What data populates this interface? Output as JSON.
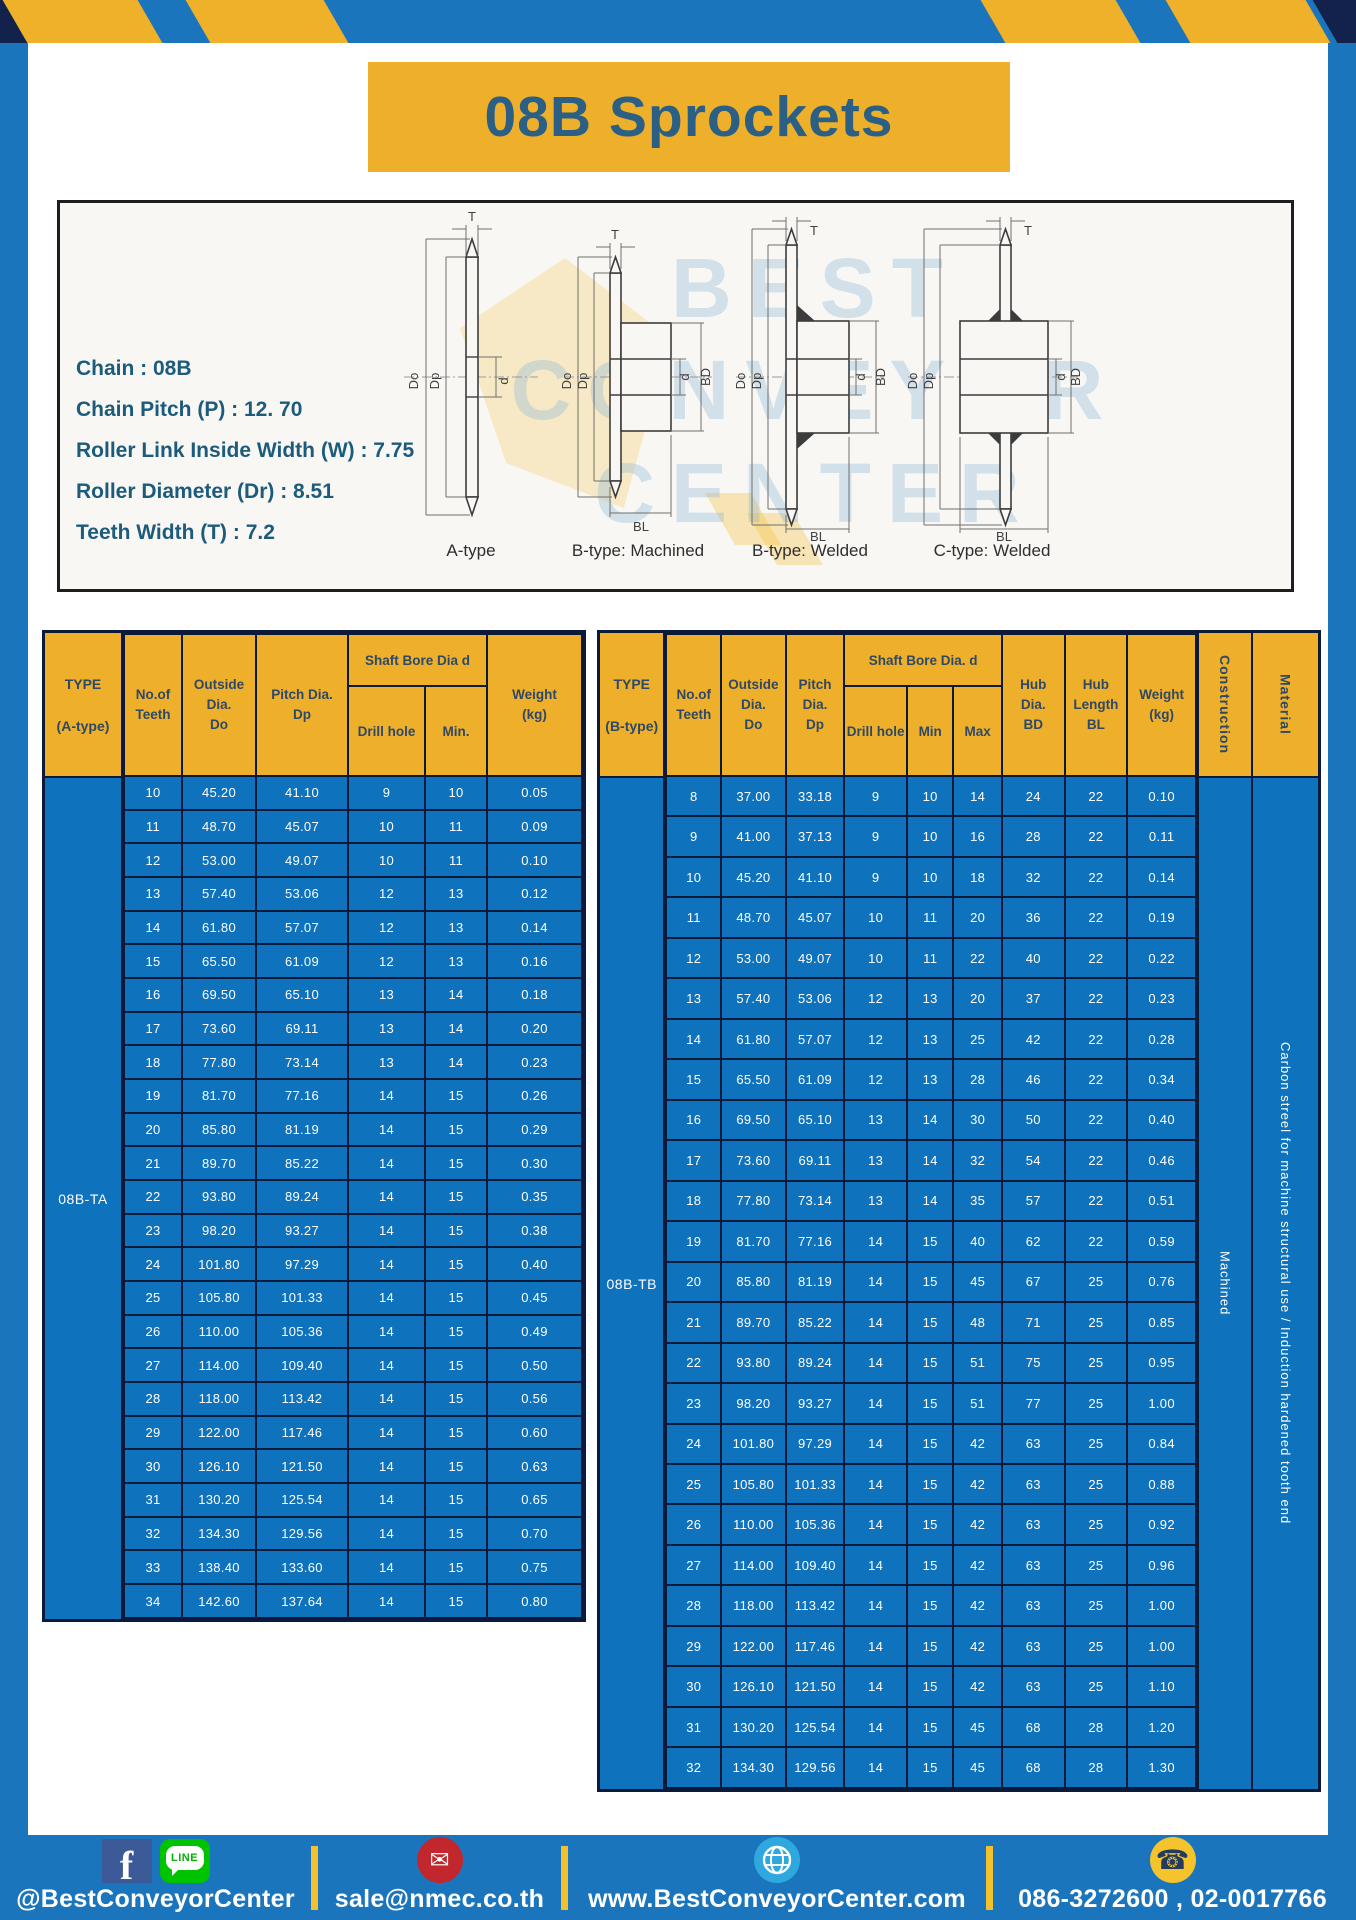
{
  "title": "08B Sprockets",
  "specs": {
    "lines": [
      "Chain : 08B",
      "Chain Pitch (P) : 12. 70",
      "Roller Link Inside Width (W) : 7.75",
      "Roller Diameter (Dr) : 8.51",
      "Teeth Width (T) : 7.2"
    ]
  },
  "diagram": {
    "captions": [
      "A-type",
      "B-type: Machined",
      "B-type: Welded",
      "C-type: Welded"
    ],
    "dims": {
      "t": "T",
      "do": "Do",
      "dp": "Dp",
      "d": "d",
      "bd": "BD",
      "bl": "BL"
    },
    "watermark": [
      "BEST",
      "CONVEYOR",
      "CENTER"
    ]
  },
  "table_a": {
    "type_label": "08B-TA",
    "header": {
      "type": [
        "TYPE",
        "(A-type)"
      ],
      "teeth": [
        "No.of",
        "Teeth"
      ],
      "outside": [
        "Outside",
        "Dia.",
        "Do"
      ],
      "pitch": [
        "Pitch Dia.",
        "Dp"
      ],
      "shaft_bore": "Shaft Bore Dia d",
      "drill": "Drill hole",
      "min": "Min.",
      "weight": [
        "Weight",
        "(kg)"
      ]
    },
    "rows": [
      [
        "10",
        "45.20",
        "41.10",
        "9",
        "10",
        "0.05"
      ],
      [
        "11",
        "48.70",
        "45.07",
        "10",
        "11",
        "0.09"
      ],
      [
        "12",
        "53.00",
        "49.07",
        "10",
        "11",
        "0.10"
      ],
      [
        "13",
        "57.40",
        "53.06",
        "12",
        "13",
        "0.12"
      ],
      [
        "14",
        "61.80",
        "57.07",
        "12",
        "13",
        "0.14"
      ],
      [
        "15",
        "65.50",
        "61.09",
        "12",
        "13",
        "0.16"
      ],
      [
        "16",
        "69.50",
        "65.10",
        "13",
        "14",
        "0.18"
      ],
      [
        "17",
        "73.60",
        "69.11",
        "13",
        "14",
        "0.20"
      ],
      [
        "18",
        "77.80",
        "73.14",
        "13",
        "14",
        "0.23"
      ],
      [
        "19",
        "81.70",
        "77.16",
        "14",
        "15",
        "0.26"
      ],
      [
        "20",
        "85.80",
        "81.19",
        "14",
        "15",
        "0.29"
      ],
      [
        "21",
        "89.70",
        "85.22",
        "14",
        "15",
        "0.30"
      ],
      [
        "22",
        "93.80",
        "89.24",
        "14",
        "15",
        "0.35"
      ],
      [
        "23",
        "98.20",
        "93.27",
        "14",
        "15",
        "0.38"
      ],
      [
        "24",
        "101.80",
        "97.29",
        "14",
        "15",
        "0.40"
      ],
      [
        "25",
        "105.80",
        "101.33",
        "14",
        "15",
        "0.45"
      ],
      [
        "26",
        "110.00",
        "105.36",
        "14",
        "15",
        "0.49"
      ],
      [
        "27",
        "114.00",
        "109.40",
        "14",
        "15",
        "0.50"
      ],
      [
        "28",
        "118.00",
        "113.42",
        "14",
        "15",
        "0.56"
      ],
      [
        "29",
        "122.00",
        "117.46",
        "14",
        "15",
        "0.60"
      ],
      [
        "30",
        "126.10",
        "121.50",
        "14",
        "15",
        "0.63"
      ],
      [
        "31",
        "130.20",
        "125.54",
        "14",
        "15",
        "0.65"
      ],
      [
        "32",
        "134.30",
        "129.56",
        "14",
        "15",
        "0.70"
      ],
      [
        "33",
        "138.40",
        "133.60",
        "14",
        "15",
        "0.75"
      ],
      [
        "34",
        "142.60",
        "137.64",
        "14",
        "15",
        "0.80"
      ]
    ]
  },
  "table_b": {
    "type_label": "08B-TB",
    "header": {
      "type": [
        "TYPE",
        "(B-type)"
      ],
      "teeth": [
        "No.of",
        "Teeth"
      ],
      "outside": [
        "Outside",
        "Dia.",
        "Do"
      ],
      "pitch": [
        "Pitch",
        "Dia.",
        "Dp"
      ],
      "shaft_bore": "Shaft Bore Dia. d",
      "drill": "Drill hole",
      "min": "Min",
      "max": "Max",
      "hub_dia": [
        "Hub",
        "Dia.",
        "BD"
      ],
      "hub_len": [
        "Hub",
        "Length",
        "BL"
      ],
      "weight": [
        "Weight",
        "(kg)"
      ],
      "construction": "Construction",
      "material": "Material"
    },
    "construction_value": "Machined",
    "material_value": "Carbon streel for machine structural use / Induction hardened tooth end",
    "rows": [
      [
        "8",
        "37.00",
        "33.18",
        "9",
        "10",
        "14",
        "24",
        "22",
        "0.10"
      ],
      [
        "9",
        "41.00",
        "37.13",
        "9",
        "10",
        "16",
        "28",
        "22",
        "0.11"
      ],
      [
        "10",
        "45.20",
        "41.10",
        "9",
        "10",
        "18",
        "32",
        "22",
        "0.14"
      ],
      [
        "11",
        "48.70",
        "45.07",
        "10",
        "11",
        "20",
        "36",
        "22",
        "0.19"
      ],
      [
        "12",
        "53.00",
        "49.07",
        "10",
        "11",
        "22",
        "40",
        "22",
        "0.22"
      ],
      [
        "13",
        "57.40",
        "53.06",
        "12",
        "13",
        "20",
        "37",
        "22",
        "0.23"
      ],
      [
        "14",
        "61.80",
        "57.07",
        "12",
        "13",
        "25",
        "42",
        "22",
        "0.28"
      ],
      [
        "15",
        "65.50",
        "61.09",
        "12",
        "13",
        "28",
        "46",
        "22",
        "0.34"
      ],
      [
        "16",
        "69.50",
        "65.10",
        "13",
        "14",
        "30",
        "50",
        "22",
        "0.40"
      ],
      [
        "17",
        "73.60",
        "69.11",
        "13",
        "14",
        "32",
        "54",
        "22",
        "0.46"
      ],
      [
        "18",
        "77.80",
        "73.14",
        "13",
        "14",
        "35",
        "57",
        "22",
        "0.51"
      ],
      [
        "19",
        "81.70",
        "77.16",
        "14",
        "15",
        "40",
        "62",
        "22",
        "0.59"
      ],
      [
        "20",
        "85.80",
        "81.19",
        "14",
        "15",
        "45",
        "67",
        "25",
        "0.76"
      ],
      [
        "21",
        "89.70",
        "85.22",
        "14",
        "15",
        "48",
        "71",
        "25",
        "0.85"
      ],
      [
        "22",
        "93.80",
        "89.24",
        "14",
        "15",
        "51",
        "75",
        "25",
        "0.95"
      ],
      [
        "23",
        "98.20",
        "93.27",
        "14",
        "15",
        "51",
        "77",
        "25",
        "1.00"
      ],
      [
        "24",
        "101.80",
        "97.29",
        "14",
        "15",
        "42",
        "63",
        "25",
        "0.84"
      ],
      [
        "25",
        "105.80",
        "101.33",
        "14",
        "15",
        "42",
        "63",
        "25",
        "0.88"
      ],
      [
        "26",
        "110.00",
        "105.36",
        "14",
        "15",
        "42",
        "63",
        "25",
        "0.92"
      ],
      [
        "27",
        "114.00",
        "109.40",
        "14",
        "15",
        "42",
        "63",
        "25",
        "0.96"
      ],
      [
        "28",
        "118.00",
        "113.42",
        "14",
        "15",
        "42",
        "63",
        "25",
        "1.00"
      ],
      [
        "29",
        "122.00",
        "117.46",
        "14",
        "15",
        "42",
        "63",
        "25",
        "1.00"
      ],
      [
        "30",
        "126.10",
        "121.50",
        "14",
        "15",
        "42",
        "63",
        "25",
        "1.10"
      ],
      [
        "31",
        "130.20",
        "125.54",
        "14",
        "15",
        "45",
        "68",
        "28",
        "1.20"
      ],
      [
        "32",
        "134.30",
        "129.56",
        "14",
        "15",
        "45",
        "68",
        "28",
        "1.30"
      ]
    ]
  },
  "footer": {
    "social_handle": "@BestConveyorCenter",
    "email": "sale@nmec.co.th",
    "website": "www.BestConveyorCenter.com",
    "phones": "086-3272600 , 02-0017766",
    "facebook_glyph": "f",
    "line_text": "LINE",
    "mail_glyph": "✉",
    "phone_glyph": "☎"
  },
  "colors": {
    "frame_blue": "#1b75bc",
    "cell_blue": "#0f72bd",
    "header_yellow": "#eeb02b",
    "border_navy": "#0c1a3a",
    "title_text": "#2b5f84",
    "spec_text": "#1d5b7d",
    "facebook_blue": "#3d5a98",
    "line_green": "#00c300",
    "mail_red": "#c1272d",
    "globe_blue": "#2fa8df",
    "phone_yellow": "#f5c42c"
  }
}
